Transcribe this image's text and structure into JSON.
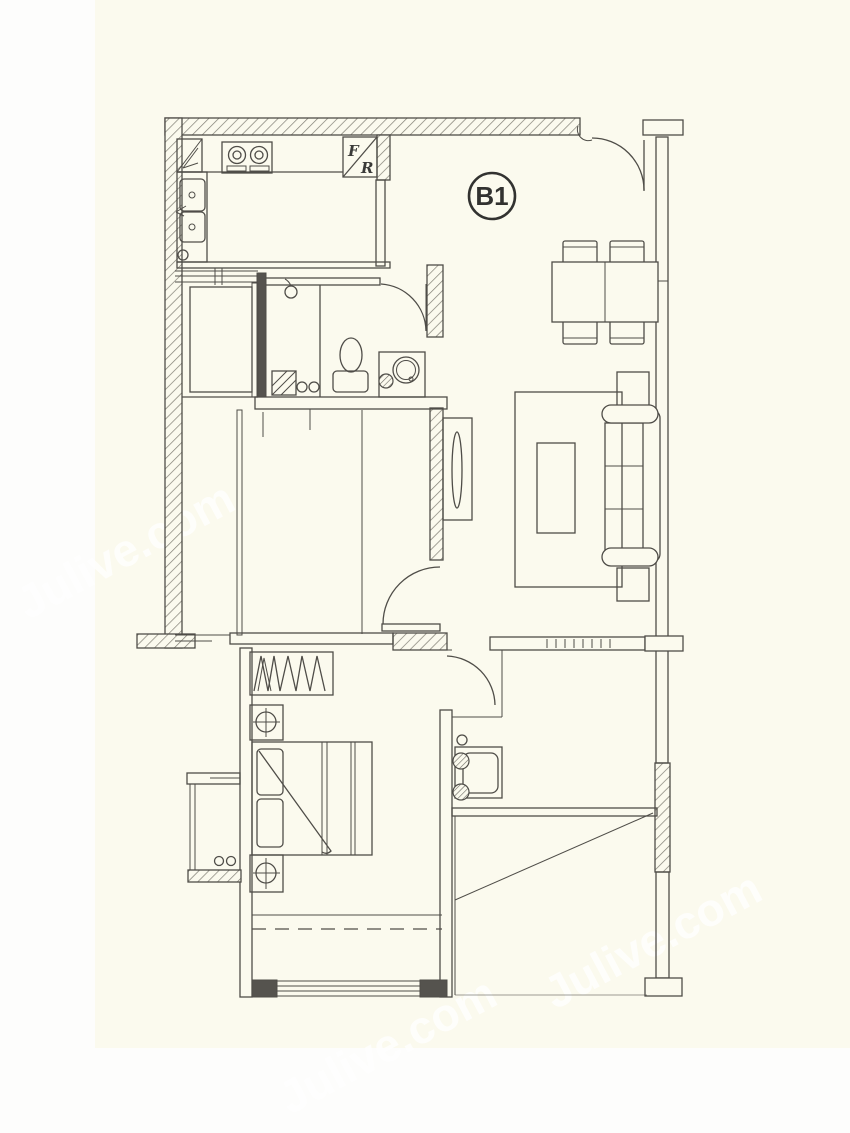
{
  "title": "apartment-floor-plan",
  "unit_label": "B1",
  "refrigerator": {
    "letter_top": "F",
    "letter_bottom": "R"
  },
  "watermark_text": "Julive.com",
  "colors": {
    "line": "#4f4d48",
    "solid_wall": "#55534e",
    "paper": "#fbfaee",
    "margin": "#fdfdfc",
    "watermark": "#ffffff",
    "hatch": "#807e74"
  }
}
